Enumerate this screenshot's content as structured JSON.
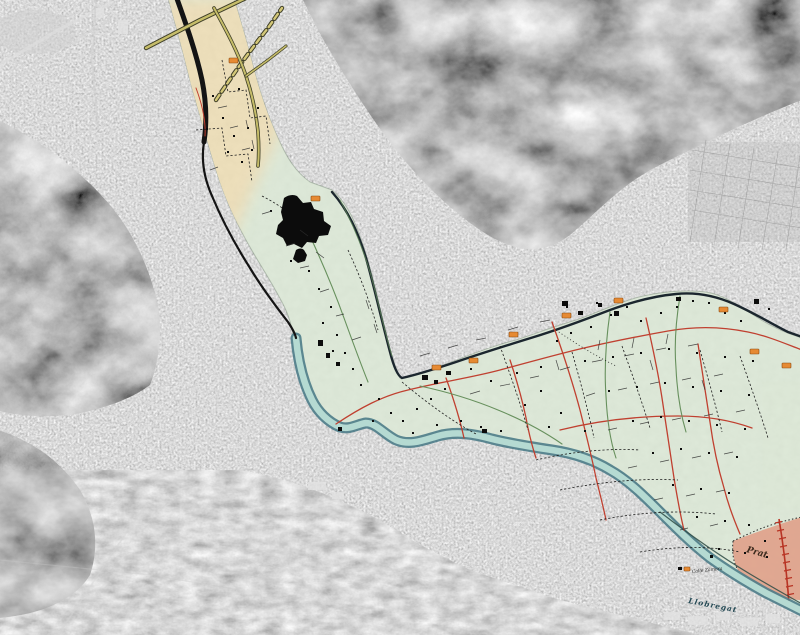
{
  "title": "Grayscale aerial photograph with georeferenced historic map overlay of the Llobregat river valley",
  "overlay_labels": {
    "town": "Prat",
    "river": "Llobregat",
    "street": "Calle Zamora"
  },
  "map_features": {
    "river_name": "Llobregat",
    "town_district": "Prat",
    "overlay_zones": [
      "cream northern valley section",
      "pale green delta plain",
      "pink town area of Prat"
    ],
    "symbols": [
      "thick black railway line",
      "olive-yellow highways",
      "red secondary roads",
      "green local roads",
      "black dashed paths",
      "orange route markers",
      "black building blocks"
    ]
  },
  "colors": {
    "overlay_green": "#dbe8d4",
    "overlay_cream": "#edddb2",
    "town_pink": "#dfa28b",
    "river_fill": "#b5dad2",
    "river_edge": "#4d7c88",
    "road_red": "#c04030",
    "road_olive": "#c6bd6a",
    "road_dark": "#1b262e",
    "road_green": "#67905d",
    "marker_orange": "#e68a33",
    "railway_black": "#141414",
    "photo_gray": "#9a9a9a"
  }
}
